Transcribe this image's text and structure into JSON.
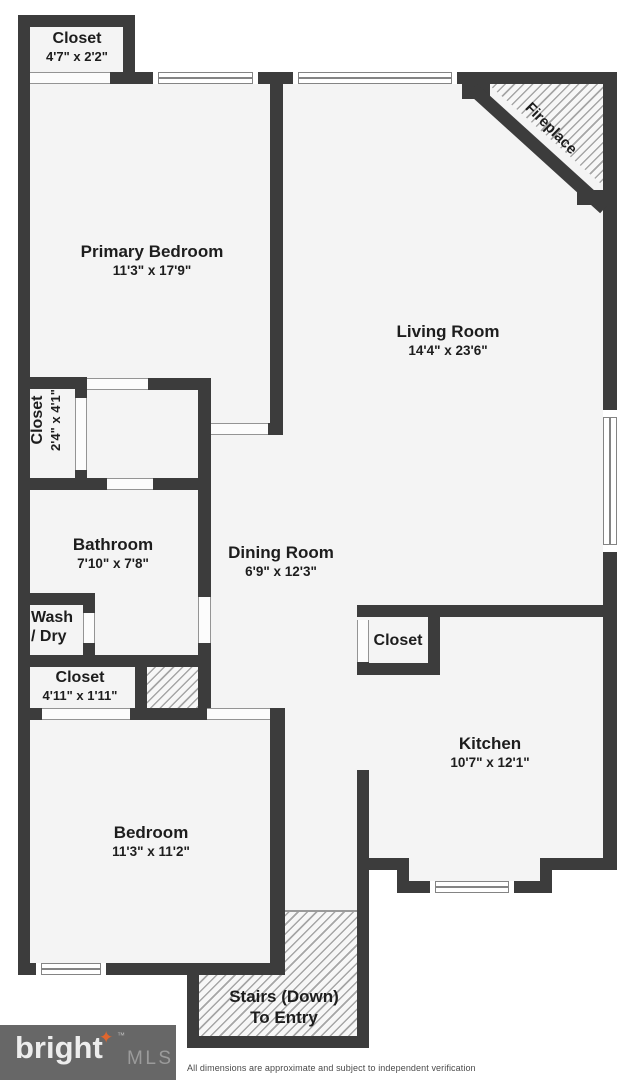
{
  "colors": {
    "wall": "#3c3c3c",
    "floor": "#f4f4f4",
    "logo_background": "#676767",
    "logo_star": "#e0662e"
  },
  "rooms": {
    "closet_top_left": {
      "name": "Closet",
      "dims": "4'7\" x 2'2\""
    },
    "primary_bedroom": {
      "name": "Primary Bedroom",
      "dims": "11'3\" x 17'9\""
    },
    "living_room": {
      "name": "Living Room",
      "dims": "14'4\" x 23'6\""
    },
    "closet_hall": {
      "name": "Closet",
      "dims": "2'4\" x 4'1\""
    },
    "bathroom": {
      "name": "Bathroom",
      "dims": "7'10\" x 7'8\""
    },
    "dining_room": {
      "name": "Dining Room",
      "dims": "6'9\" x 12'3\""
    },
    "wash_dry": {
      "line1": "Wash",
      "line2": "/ Dry"
    },
    "closet_bedroom": {
      "name": "Closet",
      "dims": "4'11\" x 1'11\""
    },
    "closet_kitchen": {
      "name": "Closet"
    },
    "kitchen": {
      "name": "Kitchen",
      "dims": "10'7\" x 12'1\""
    },
    "bedroom": {
      "name": "Bedroom",
      "dims": "11'3\" x 11'2\""
    },
    "stairs": {
      "line1": "Stairs (Down)",
      "line2": "To Entry"
    },
    "fireplace": {
      "name": "Fireplace"
    }
  },
  "footer": {
    "disclaimer": "All dimensions are approximate and subject to independent verification"
  },
  "logo": {
    "brand": "bright",
    "tm": "™",
    "star": "✦",
    "suffix": "MLS"
  }
}
